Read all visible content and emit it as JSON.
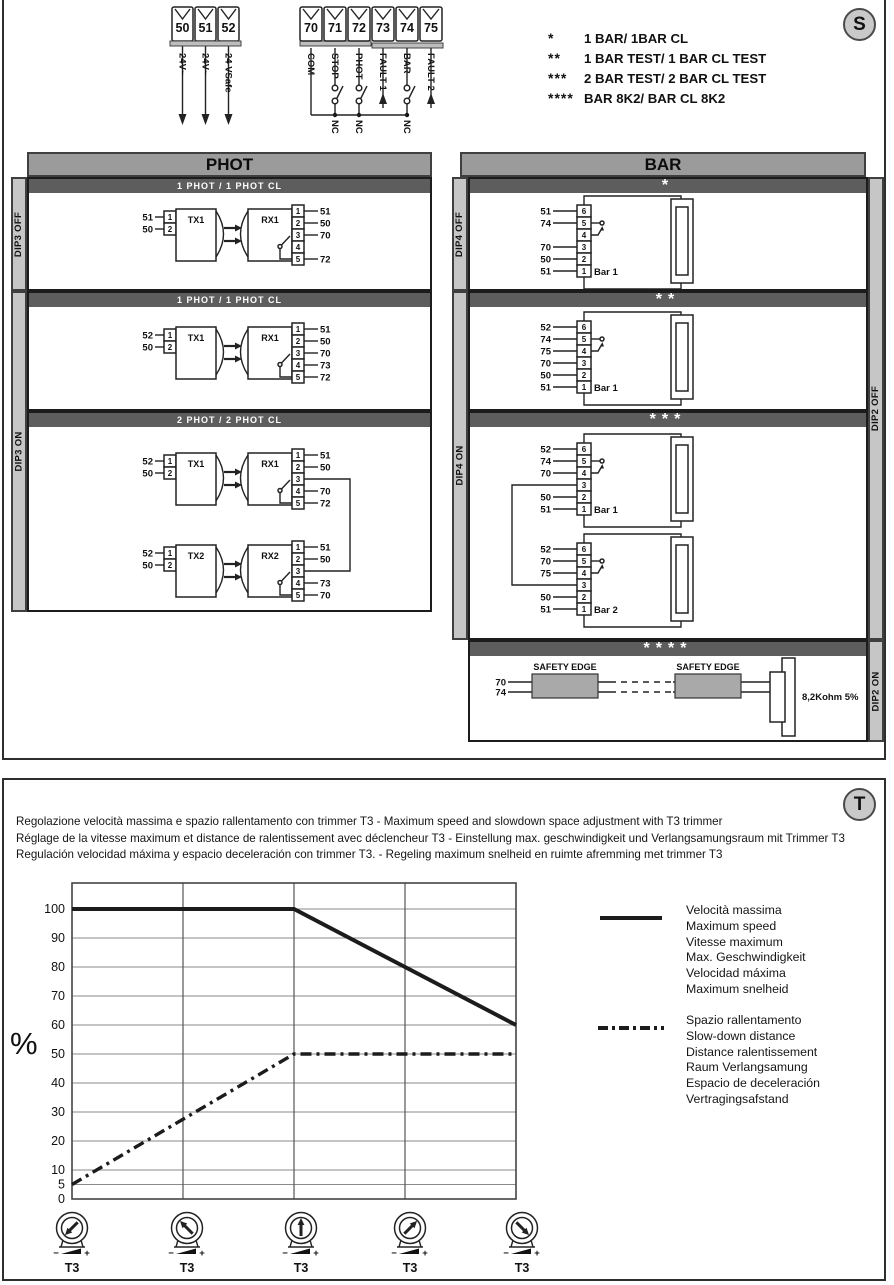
{
  "badges": {
    "s": "S",
    "t": "T"
  },
  "terminal_block_1": {
    "terminals": [
      {
        "n": "50",
        "label": "24V~"
      },
      {
        "n": "51",
        "label": "24V~"
      },
      {
        "n": "52",
        "label": "24 VSafe"
      }
    ]
  },
  "terminal_block_2": {
    "terminals": [
      {
        "n": "70",
        "label": "COM",
        "type": "com"
      },
      {
        "n": "71",
        "label": "STOP",
        "type": "nc"
      },
      {
        "n": "72",
        "label": "PHOT",
        "type": "nc"
      },
      {
        "n": "73",
        "label": "FAULT 1",
        "type": "arrow"
      },
      {
        "n": "74",
        "label": "BAR",
        "type": "nc"
      },
      {
        "n": "75",
        "label": "FAULT 2",
        "type": "arrow"
      }
    ],
    "nc_label": "NC"
  },
  "legend_s": {
    "items": [
      {
        "stars": "*",
        "label": "1 BAR/ 1BAR CL"
      },
      {
        "stars": "**",
        "label": "1 BAR TEST/ 1 BAR CL TEST"
      },
      {
        "stars": "***",
        "label": "2 BAR TEST/ 2 BAR CL TEST"
      },
      {
        "stars": "****",
        "label": "BAR 8K2/ BAR CL 8K2"
      }
    ]
  },
  "phot": {
    "title": "PHOT",
    "dip_labels": {
      "off": "DIP3 OFF",
      "on": "DIP3 ON"
    },
    "pin_numbers": {
      "tx": [
        "1",
        "2"
      ],
      "rx": [
        "1",
        "2",
        "3",
        "4",
        "5"
      ]
    },
    "sections": [
      {
        "header": "1 PHOT / 1 PHOT CL",
        "pairs": [
          {
            "tx": "TX1",
            "rx": "RX1",
            "tx_wires": [
              "51",
              "50"
            ],
            "rx_wires": [
              "51",
              "50",
              "70",
              "",
              "72"
            ]
          }
        ]
      },
      {
        "header": "1 PHOT / 1 PHOT CL",
        "pairs": [
          {
            "tx": "TX1",
            "rx": "RX1",
            "tx_wires": [
              "52",
              "50"
            ],
            "rx_wires": [
              "51",
              "50",
              "70",
              "73",
              "72"
            ]
          }
        ]
      },
      {
        "header": "2 PHOT / 2 PHOT CL",
        "pairs": [
          {
            "tx": "TX1",
            "rx": "RX1",
            "tx_wires": [
              "52",
              "50"
            ],
            "rx_wires": [
              "51",
              "50",
              "",
              "70",
              "72"
            ]
          },
          {
            "tx": "TX2",
            "rx": "RX2",
            "tx_wires": [
              "52",
              "50"
            ],
            "rx_wires": [
              "51",
              "50",
              "",
              "73",
              "70"
            ]
          }
        ]
      }
    ]
  },
  "bar": {
    "title": "BAR",
    "dip_labels": {
      "dip4_off": "DIP4 OFF",
      "dip4_on": "DIP4 ON",
      "dip2_off": "DIP2 OFF",
      "dip2_on": "DIP2 ON"
    },
    "pin_numbers": [
      "6",
      "5",
      "4",
      "3",
      "2",
      "1"
    ],
    "sections": [
      {
        "header": "*",
        "bars": [
          {
            "name": "Bar 1",
            "wires": [
              "51",
              "74",
              "",
              "70",
              "50",
              "51"
            ]
          }
        ]
      },
      {
        "header": "**",
        "bars": [
          {
            "name": "Bar 1",
            "wires": [
              "52",
              "74",
              "75",
              "70",
              "50",
              "51"
            ]
          }
        ]
      },
      {
        "header": "***",
        "bars": [
          {
            "name": "Bar 1",
            "wires": [
              "52",
              "74",
              "70",
              "",
              "50",
              "51"
            ]
          },
          {
            "name": "Bar 2",
            "wires": [
              "52",
              "70",
              "75",
              "",
              "50",
              "51"
            ]
          }
        ]
      },
      {
        "header": "****",
        "edge_label": "SAFETY EDGE",
        "wire_labels": [
          "70",
          "74"
        ],
        "resistor_label": "8,2Kohm 5%"
      }
    ]
  },
  "t_section": {
    "lines": [
      "Regolazione velocità massima e spazio rallentamento con trimmer T3 - Maximum speed and slowdown space adjustment with T3 trimmer",
      "Réglage de la vitesse maximum et distance de ralentissement avec déclencheur T3 - Einstellung max. geschwindigkeit und Verlangsamungsraum mit Trimmer T3",
      "Regulación velocidad máxima y espacio deceleración con trimmer T3. - Regeling maximum snelheid en ruimte afremming met trimmer T3"
    ],
    "trimmer_label": "T3",
    "trimmer_minus": "−",
    "trimmer_plus": "+",
    "trimmers": {
      "angles_deg": [
        -135,
        -45,
        0,
        45,
        135
      ]
    },
    "legend": [
      {
        "style": "solid",
        "labels": [
          "Velocità massima",
          "Maximum speed",
          "Vitesse maximum",
          "Max. Geschwindigkeit",
          "Velocidad máxima",
          "Maximum snelheid"
        ]
      },
      {
        "style": "dash-dot",
        "labels": [
          "Spazio rallentamento",
          "Slow-down distance",
          "Distance ralentissement",
          "Raum Verlangsamung",
          "Espacio de deceleración",
          "Vertragingsafstand"
        ]
      }
    ]
  },
  "chart_data": {
    "type": "line",
    "ylabel": "%",
    "yticks": [
      0,
      5,
      10,
      20,
      30,
      40,
      50,
      60,
      70,
      80,
      90,
      100
    ],
    "ylim": [
      0,
      110
    ],
    "x_positions": 5,
    "grid": true,
    "legend_position": "right",
    "series": [
      {
        "name": "Velocità massima",
        "style": "solid",
        "points": [
          [
            0,
            100
          ],
          [
            2,
            100
          ],
          [
            3,
            80
          ],
          [
            4,
            60
          ]
        ]
      },
      {
        "name": "Spazio rallentamento",
        "style": "dash-dot",
        "points": [
          [
            0,
            5
          ],
          [
            2,
            50
          ],
          [
            4,
            50
          ]
        ]
      }
    ]
  }
}
